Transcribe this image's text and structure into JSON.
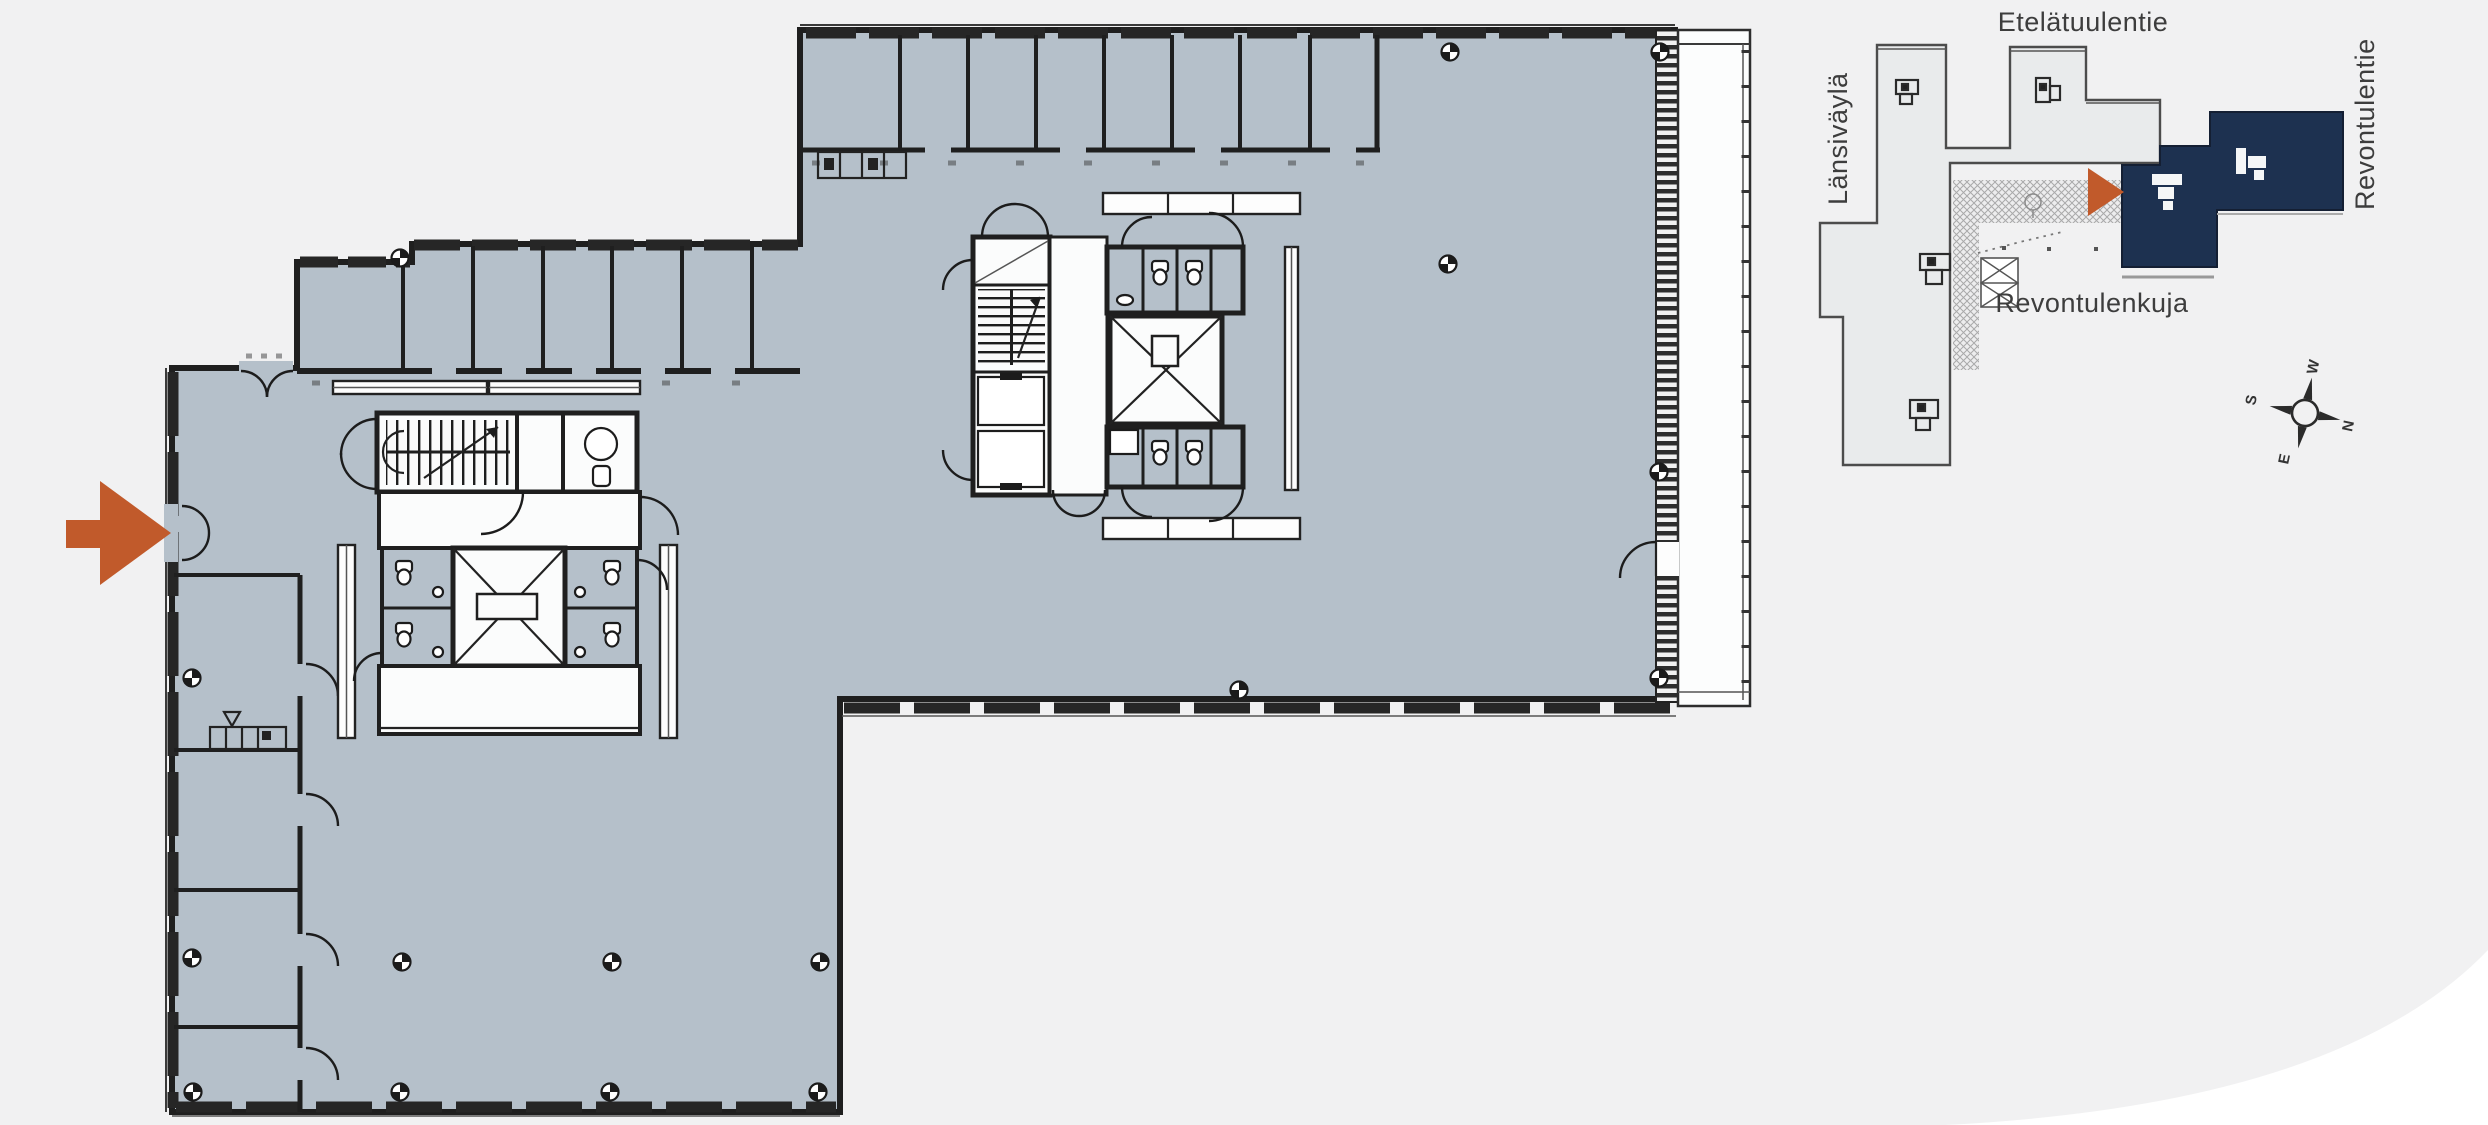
{
  "figure": {
    "kind": "office-floor-plan-with-site-map"
  },
  "site_map": {
    "streets": {
      "top": "Etelätuulentie",
      "left": "Länsiväylä",
      "right": "Revontulentie",
      "bottom": "Revontulenkuja"
    },
    "compass": {
      "north": "N",
      "east": "E",
      "south": "S",
      "west": "W"
    }
  },
  "colors": {
    "background": "#f1f1f2",
    "floor": "#b5c0ca",
    "wall": "#1f1f1f",
    "white": "#fbfcfc",
    "accent_orange": "#c15a2b",
    "navy": "#1d3150",
    "minimap_fill": "#e9ebec",
    "minimap_outline": "#4c4c4c",
    "text": "#3d3d3d"
  }
}
